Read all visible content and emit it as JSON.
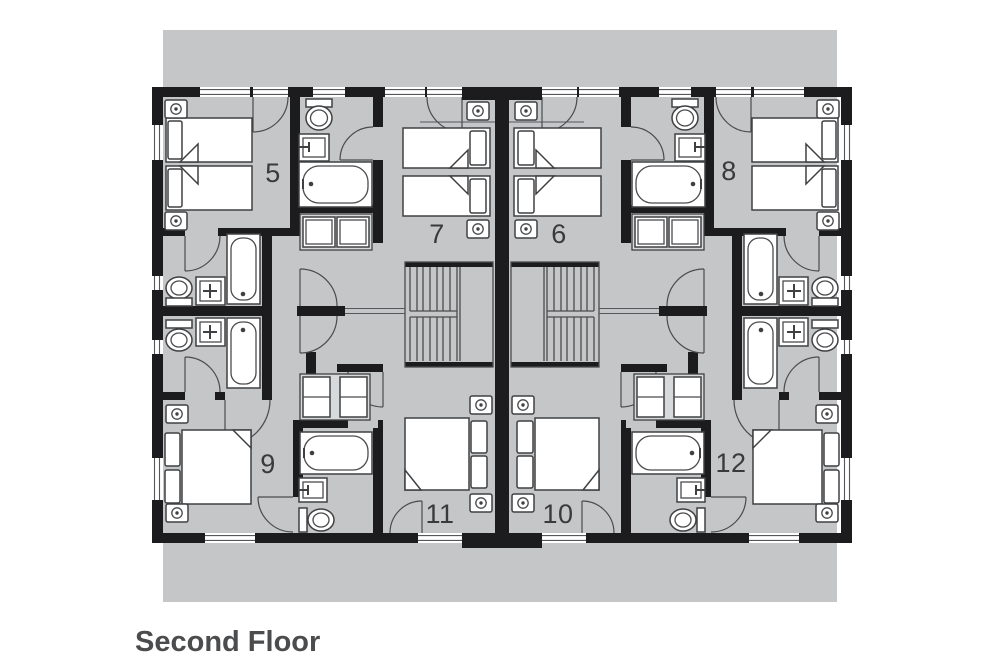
{
  "page": {
    "title_label": "Second Floor"
  },
  "rooms": [
    {
      "number": "5"
    },
    {
      "number": "7"
    },
    {
      "number": "6"
    },
    {
      "number": "8"
    },
    {
      "number": "9"
    },
    {
      "number": "11"
    },
    {
      "number": "10"
    },
    {
      "number": "12"
    }
  ],
  "colors": {
    "backdrop": "#c4c6c8",
    "wall": "#1c1c1e",
    "line": "#4b4b4d",
    "fixture": "#3f4042",
    "room_number": "#3a3a3c",
    "title": "#4b4c4e"
  },
  "icons": {
    "power-outlet-icon": "circle-in-square",
    "bathtub-icon": "rounded-basin",
    "toilet-icon": "oval-bowl-with-tank",
    "sink-icon": "square-basin-with-tap",
    "staircase-icon": "parallel-treads",
    "door-swing-icon": "quarter-arc",
    "window-icon": "double-line-gap",
    "wardrobe-icon": "split-cabinet",
    "twin-bed-icon": "mattress-with-pillow",
    "double-bed-icon": "mattress-with-two-pillows"
  }
}
